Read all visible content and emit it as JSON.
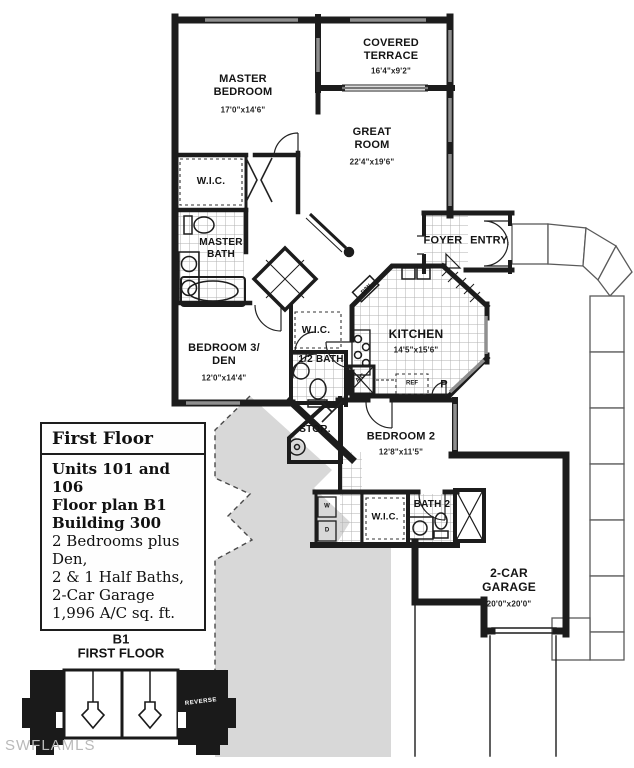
{
  "watermark": "SWFLAMLS",
  "plan": {
    "rooms": {
      "master_bedroom": {
        "label": "MASTER\nBEDROOM",
        "dims": "17'0\"x14'6\""
      },
      "covered_terrace": {
        "label": "COVERED\nTERRACE",
        "dims": "16'4\"x9'2\""
      },
      "great_room": {
        "label": "GREAT\nROOM",
        "dims": "22'4\"x19'6\""
      },
      "master_wic": {
        "label": "W.I.C."
      },
      "master_bath": {
        "label": "MASTER\nBATH"
      },
      "bedroom3_den": {
        "label": "BEDROOM 3/\nDEN",
        "dims": "12'0\"x14'4\""
      },
      "hall_wic": {
        "label": "W.I.C."
      },
      "half_bath": {
        "label": "1/2 BATH"
      },
      "kitchen": {
        "label": "KITCHEN",
        "dims": "14'5\"x15'6\""
      },
      "foyer": {
        "label": "FOYER"
      },
      "entry": {
        "label": "ENTRY"
      },
      "storage": {
        "label": "STOR."
      },
      "bedroom2": {
        "label": "BEDROOM 2",
        "dims": "12'8\"x11'5\""
      },
      "bedroom2_wic": {
        "label": "W.I.C."
      },
      "bath2": {
        "label": "BATH 2"
      },
      "garage": {
        "label": "2-CAR\nGARAGE",
        "dims": "20'0\"x20'0\""
      }
    },
    "appliances": {
      "dishwasher": "D/W",
      "refrigerator": "REF",
      "pantry": "P",
      "air_conditioner": "A/C",
      "washer": "W",
      "dryer": "D"
    }
  },
  "info_box": {
    "title": "First Floor",
    "lines": [
      "Units 101 and 106",
      "Floor plan B1",
      "Building 300",
      "2 Bedrooms plus Den,",
      "2 & 1 Half Baths,",
      "2-Car Garage",
      "1,996 A/C sq. ft."
    ]
  },
  "key_plan": {
    "title": "B1\nFIRST FLOOR",
    "reverse": "REVERSE"
  },
  "colors": {
    "wall": "#1c1c1c",
    "window": "#8f8f8f",
    "driveway_gray": "#d8d8d8",
    "tile_line": "#b0b0b0",
    "watermark_gray": "#b9b9b9"
  }
}
